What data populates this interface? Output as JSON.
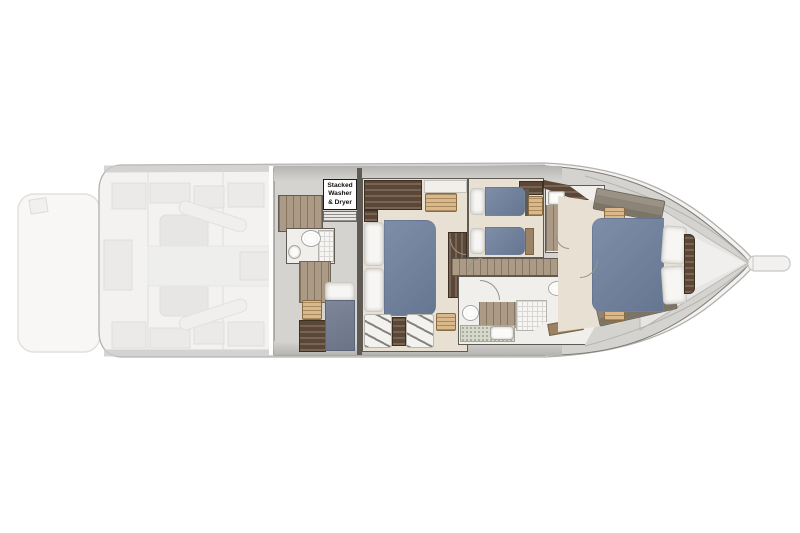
{
  "labels": {
    "washer": {
      "line1": "Stacked",
      "line2": "Washer",
      "line3": "& Dryer"
    }
  },
  "palette": {
    "hull-line": "#b3b1ae",
    "ghost-bg": "#f3f2f1",
    "ghost-block": "#e9e8e6",
    "ghost-line": "#d9d8d6",
    "deck": "#d5d3cf",
    "band-dark": "#b6b4b2",
    "wall": "#5f5b54",
    "cream": "#e8e0d3",
    "wood": "#ab9b86",
    "wood-line": "#87755f",
    "wood-mid": "#9c8265",
    "walnut": "#5c4736",
    "wicker": "#d9b98b",
    "wicker-line": "#8a6b42",
    "duvet": "#7e8ea8",
    "duvet-dark": "#667691",
    "pillow": "#f7f6f4",
    "pillow-line": "#cccac4",
    "slate": "#7d8798",
    "taupe": "#8b8477",
    "tile": "#f6f5f3",
    "tile-line": "#d8d7d3",
    "white-floor": "#f0efec",
    "fix-line": "#a9a7a2",
    "speckle-base": "#d6d8cb",
    "speckle-dot": "#9fa391",
    "bow": "#e6e5e3",
    "bow-inner": "#f0efed",
    "sprit": "#f2f1f0",
    "sprit-line": "#c8c7c5",
    "label-border": "#1a1a1a"
  }
}
